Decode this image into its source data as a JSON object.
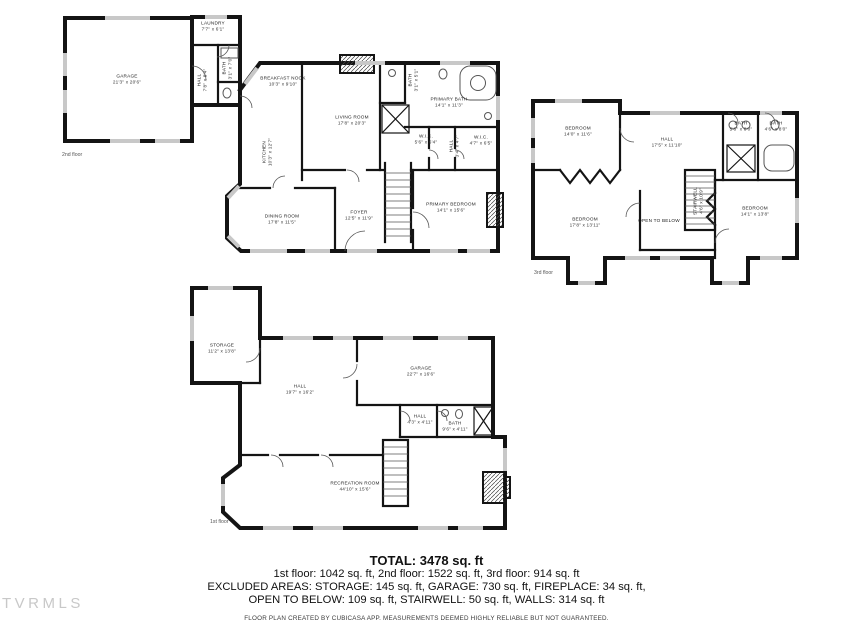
{
  "watermark": "TVRMLS",
  "colors": {
    "wall": "#141414",
    "window": "#c8c8c8",
    "fixture": "#555555"
  },
  "summary": {
    "total": "TOTAL: 3478 sq. ft",
    "floors_line": "1st floor: 1042 sq. ft, 2nd floor: 1522 sq. ft, 3rd floor: 914 sq. ft",
    "excluded_line1": "EXCLUDED AREAS: STORAGE: 145 sq. ft, GARAGE: 730 sq. ft, FIREPLACE: 34 sq. ft,",
    "excluded_line2": "OPEN TO BELOW: 109 sq. ft, STAIRWELL: 50 sq. ft, WALLS: 314 sq. ft",
    "disclaimer": "FLOOR PLAN CREATED BY CUBICASA APP. MEASUREMENTS DEEMED HIGHLY RELIABLE BUT NOT GUARANTEED."
  },
  "floors": {
    "second": {
      "caption": "2nd floor",
      "rooms": [
        {
          "name": "GARAGE",
          "dims": "21'3\" x 20'6\"",
          "x": 127,
          "y": 80,
          "rot": false
        },
        {
          "name": "LAUNDRY",
          "dims": "7'7\" x 6'1\"",
          "x": 213,
          "y": 27,
          "rot": false
        },
        {
          "name": "HALL",
          "dims": "7'8\" x 8'4\"",
          "x": 203,
          "y": 80,
          "rot": true
        },
        {
          "name": "BATH",
          "dims": "3'1\" x 7'0\"",
          "x": 228,
          "y": 68,
          "rot": true
        },
        {
          "name": "BREAKFAST NOOK",
          "dims": "10'3\" x 9'10\"",
          "x": 283,
          "y": 82,
          "rot": false
        },
        {
          "name": "KITCHEN",
          "dims": "10'3\" x 12'7\"",
          "x": 268,
          "y": 152,
          "rot": true
        },
        {
          "name": "LIVING ROOM",
          "dims": "17'8\" x 20'3\"",
          "x": 352,
          "y": 121,
          "rot": false
        },
        {
          "name": "BATH",
          "dims": "3'1\" x 5'1\"",
          "x": 414,
          "y": 80,
          "rot": true
        },
        {
          "name": "PRIMARY BATH",
          "dims": "14'1\" x 11'3\"",
          "x": 449,
          "y": 103,
          "rot": false
        },
        {
          "name": "W.I.C.",
          "dims": "5'6\" x 6'4\"",
          "x": 426,
          "y": 140,
          "rot": false
        },
        {
          "name": "HALL",
          "dims": "3'4\" x 4'7\"",
          "x": 455,
          "y": 146,
          "rot": true
        },
        {
          "name": "W.I.C.",
          "dims": "4'7\" x 6'5\"",
          "x": 481,
          "y": 141,
          "rot": false
        },
        {
          "name": "DINING ROOM",
          "dims": "17'8\" x 11'5\"",
          "x": 282,
          "y": 220,
          "rot": false
        },
        {
          "name": "FOYER",
          "dims": "12'5\" x 11'9\"",
          "x": 359,
          "y": 216,
          "rot": false
        },
        {
          "name": "PRIMARY BEDROOM",
          "dims": "14'1\" x 15'6\"",
          "x": 451,
          "y": 208,
          "rot": false
        }
      ]
    },
    "third": {
      "caption": "3rd floor",
      "rooms": [
        {
          "name": "BEDROOM",
          "dims": "14'0\" x 11'6\"",
          "x": 578,
          "y": 132,
          "rot": false
        },
        {
          "name": "HALL",
          "dims": "17'5\" x 11'10\"",
          "x": 667,
          "y": 143,
          "rot": false
        },
        {
          "name": "BATH",
          "dims": "5'6\" x 8'0\"",
          "x": 741,
          "y": 127,
          "rot": false
        },
        {
          "name": "BATH",
          "dims": "4'6\" x 8'0\"",
          "x": 776,
          "y": 127,
          "rot": false
        },
        {
          "name": "BEDROOM",
          "dims": "17'8\" x 13'11\"",
          "x": 585,
          "y": 223,
          "rot": false
        },
        {
          "name": "OPEN TO BELOW",
          "dims": "",
          "x": 659,
          "y": 221,
          "rot": false
        },
        {
          "name": "STAIRWELL",
          "dims": "4'6\" x 10'9\"",
          "x": 699,
          "y": 201,
          "rot": true
        },
        {
          "name": "BEDROOM",
          "dims": "14'1\" x 13'8\"",
          "x": 755,
          "y": 212,
          "rot": false
        }
      ]
    },
    "first": {
      "caption": "1st floor",
      "rooms": [
        {
          "name": "STORAGE",
          "dims": "11'2\" x 13'8\"",
          "x": 222,
          "y": 349,
          "rot": false
        },
        {
          "name": "HALL",
          "dims": "19'7\" x 16'2\"",
          "x": 300,
          "y": 390,
          "rot": false
        },
        {
          "name": "GARAGE",
          "dims": "22'7\" x 16'6\"",
          "x": 421,
          "y": 372,
          "rot": false
        },
        {
          "name": "HALL",
          "dims": "4'3\" x 4'11\"",
          "x": 420,
          "y": 420,
          "rot": false
        },
        {
          "name": "BATH",
          "dims": "9'6\" x 4'11\"",
          "x": 455,
          "y": 427,
          "rot": false
        },
        {
          "name": "RECREATION ROOM",
          "dims": "44'10\" x 15'6\"",
          "x": 355,
          "y": 487,
          "rot": false
        }
      ]
    }
  }
}
